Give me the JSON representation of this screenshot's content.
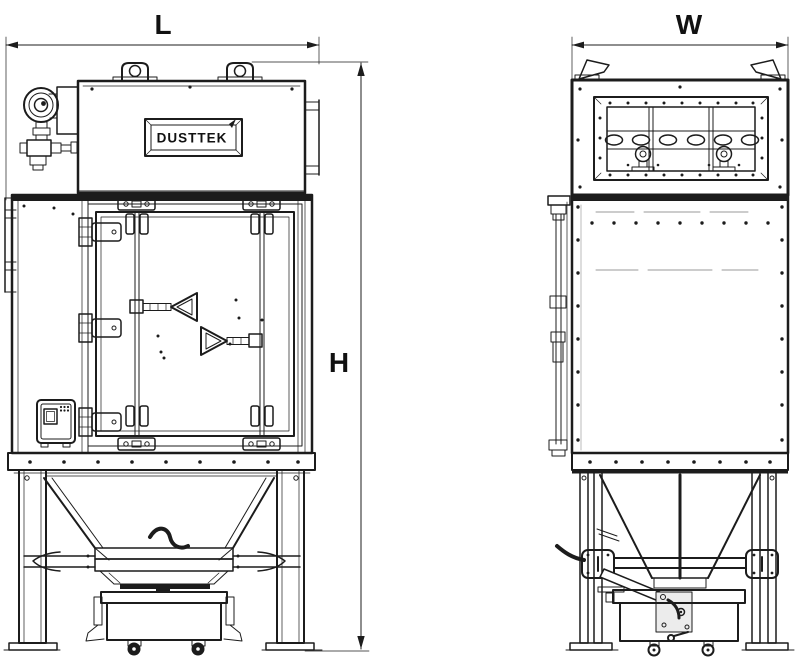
{
  "drawing": {
    "brand_label": "DUSTTEK",
    "dimension_labels": {
      "length": "L",
      "width": "W",
      "height": "H"
    },
    "colors": {
      "line": "#1c1c1c",
      "background": "#ffffff",
      "hidden_line": "#9a9a9a",
      "bracket_plate_fill": "#ececec"
    }
  }
}
